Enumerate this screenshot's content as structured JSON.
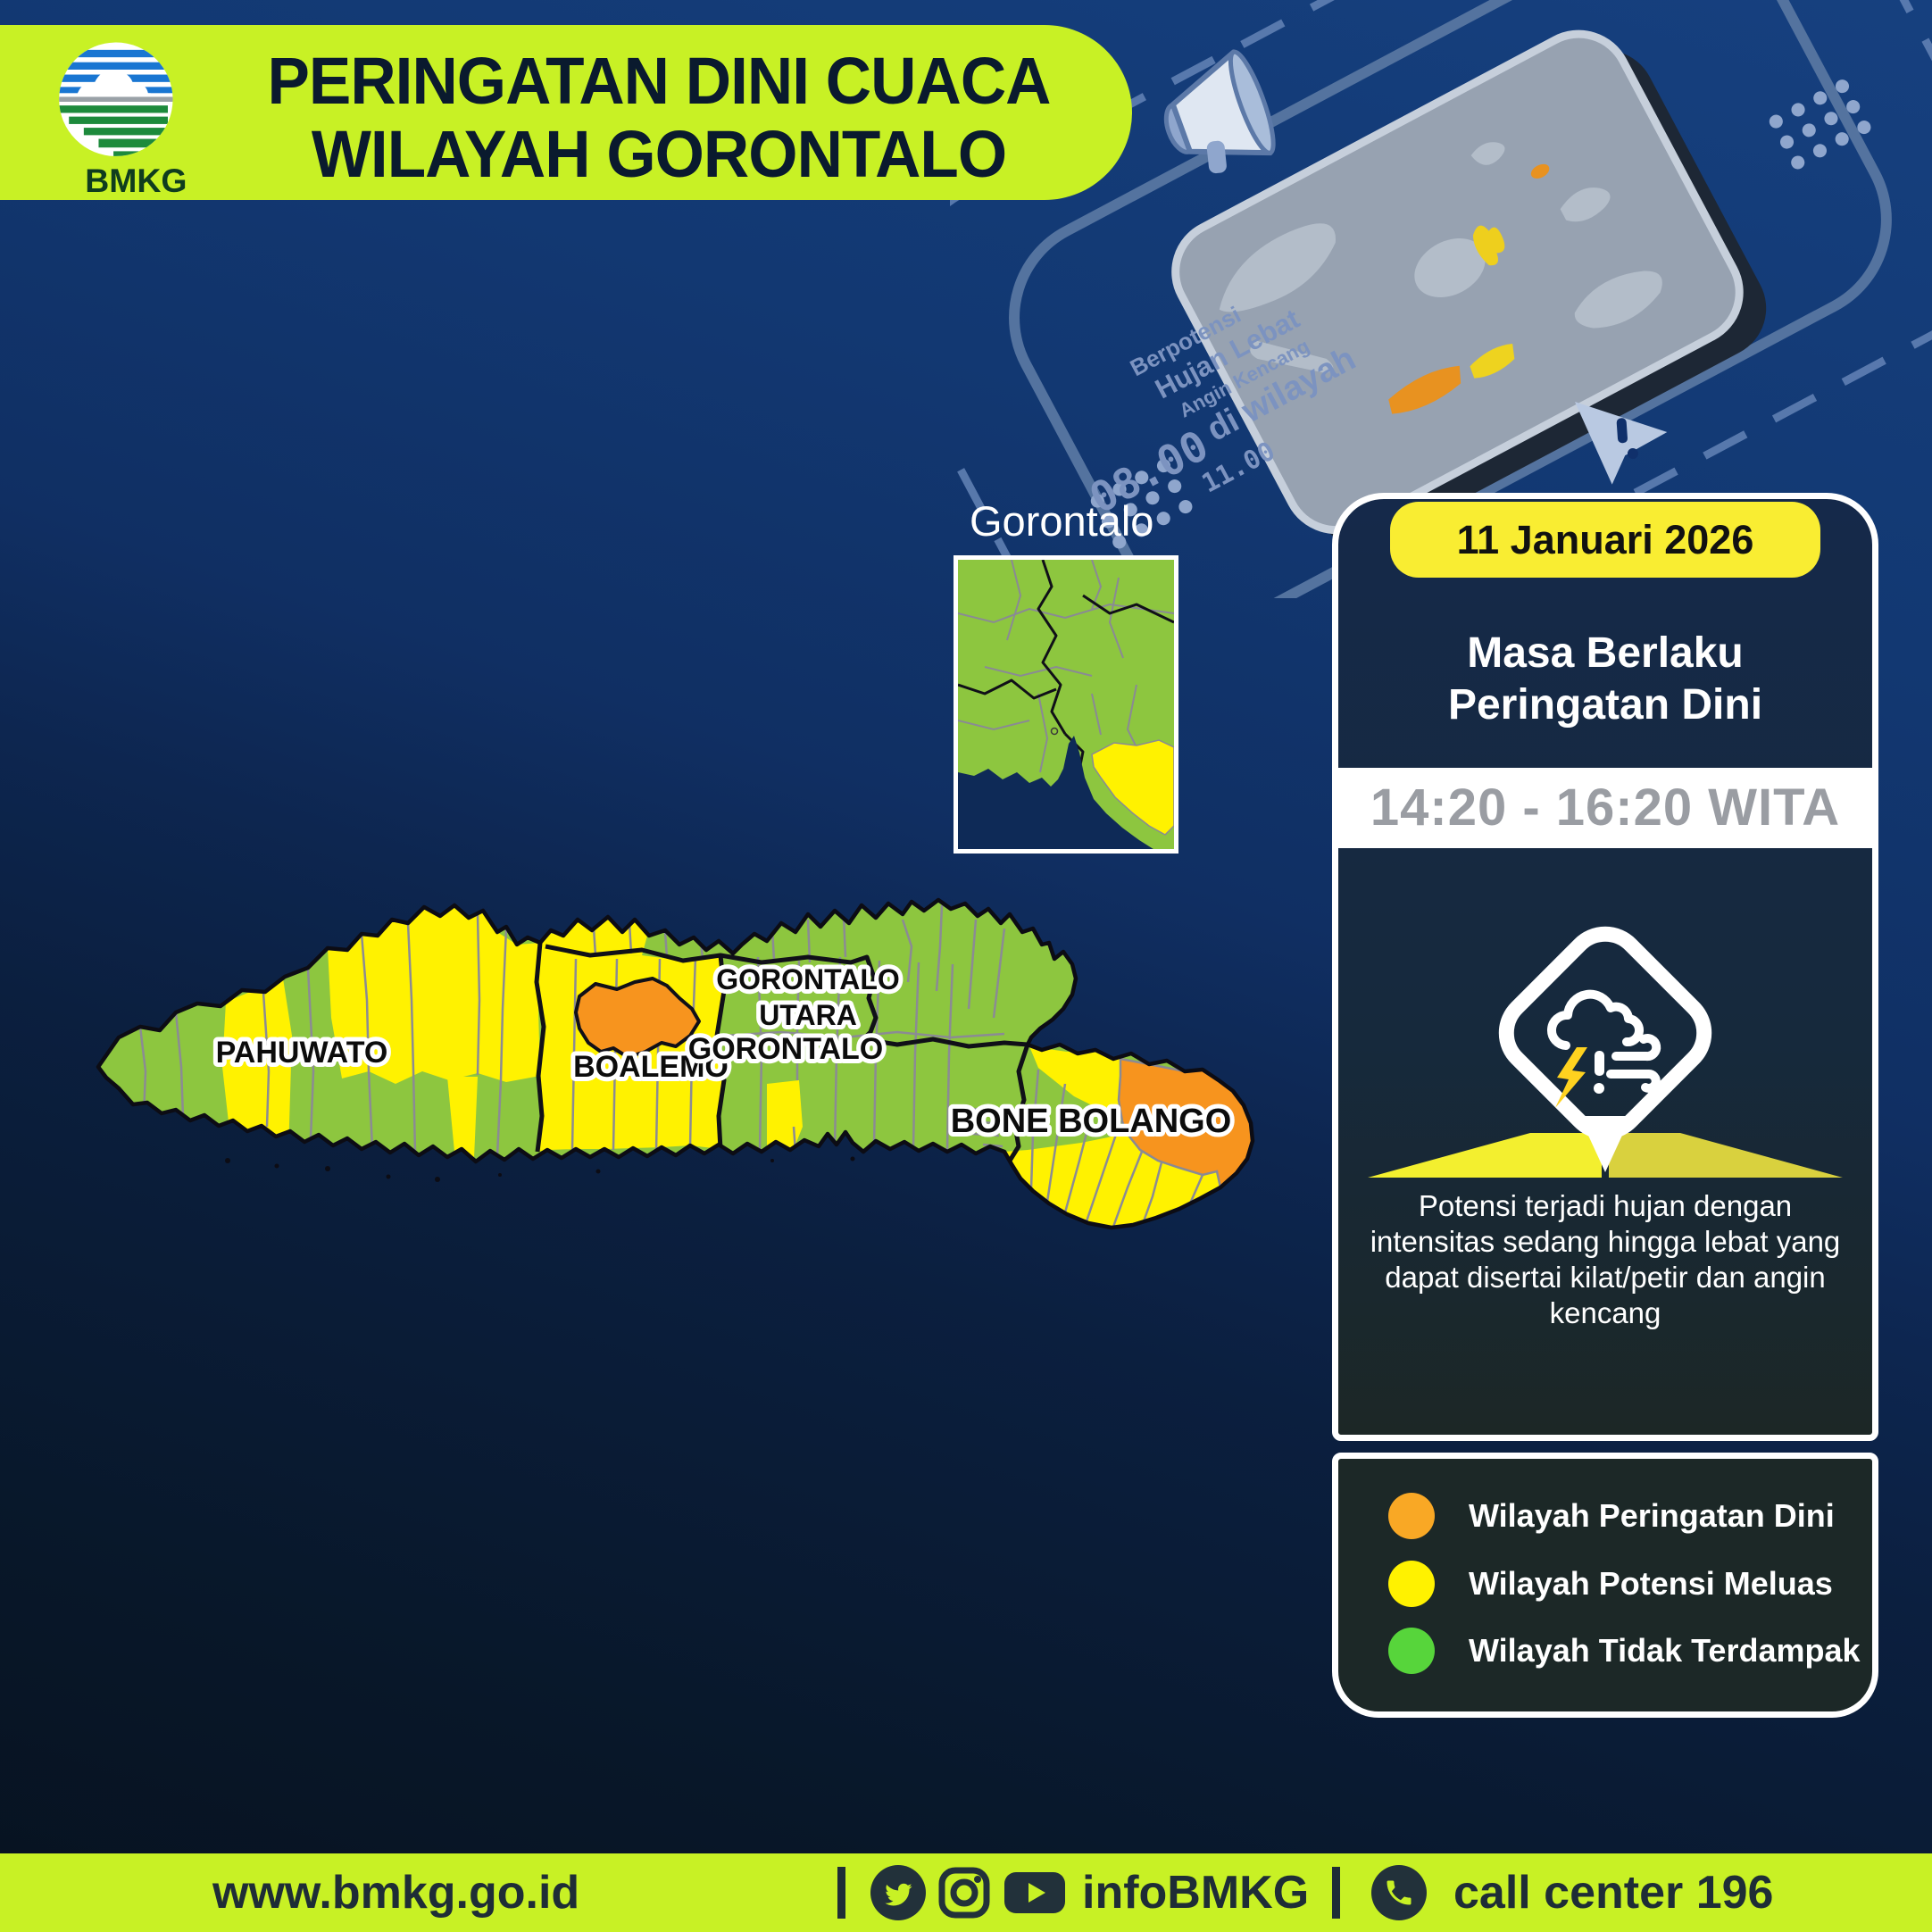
{
  "header": {
    "logo_text": "BMKG",
    "title_line1": "PERINGATAN DINI CUACA",
    "title_line2": "WILAYAH GORONTALO"
  },
  "decor": {
    "line1": "Berpotensi",
    "line2": "Hujan Lebat",
    "line3": "Angin Kencang",
    "line4": "di wilayah",
    "clock_large": "08.00",
    "clock_small": "11.00"
  },
  "inset": {
    "label": "Gorontalo"
  },
  "map": {
    "labels": {
      "pahuwato": "PAHUWATO",
      "boalemo": "BOALEMO",
      "gorontalo": "GORONTALO",
      "gorontalo_utara_line1": "GORONTALO",
      "gorontalo_utara_line2": "UTARA",
      "bone_bolango": "BONE BOLANGO"
    },
    "region_status": [
      {
        "name": "PAHUWATO",
        "colors": [
          "green",
          "yellow"
        ]
      },
      {
        "name": "BOALEMO",
        "colors": [
          "yellow",
          "orange"
        ]
      },
      {
        "name": "GORONTALO",
        "colors": [
          "green",
          "yellow"
        ]
      },
      {
        "name": "GORONTALO UTARA",
        "colors": [
          "green",
          "yellow"
        ]
      },
      {
        "name": "BONE BOLANGO",
        "colors": [
          "green",
          "yellow",
          "orange"
        ]
      }
    ]
  },
  "panel": {
    "date": "11 Januari 2026",
    "heading_line1": "Masa Berlaku",
    "heading_line2": "Peringatan Dini",
    "time_range": "14:20 - 16:20 WITA",
    "description": "Potensi terjadi hujan dengan intensitas sedang hingga lebat yang dapat disertai kilat/petir dan angin kencang"
  },
  "legend": {
    "items": [
      {
        "label": "Wilayah Peringatan Dini",
        "color": "#F9A825"
      },
      {
        "label": "Wilayah Potensi Meluas",
        "color": "#FFF200"
      },
      {
        "label": "Wilayah Tidak Terdampak",
        "color": "#57D53B"
      }
    ]
  },
  "footer": {
    "website": "www.bmkg.go.id",
    "social_handle": "infoBMKG",
    "call_center": "call center 196"
  },
  "colors": {
    "banner_green": "#C8F125",
    "background_navy": "#10316B",
    "card_navy": "#15294A",
    "panel_dark": "#1C2827",
    "map_green": "#8DC63F",
    "map_yellow": "#FFF200",
    "map_orange": "#F7941E",
    "date_tab_yellow": "#F9ED32"
  }
}
